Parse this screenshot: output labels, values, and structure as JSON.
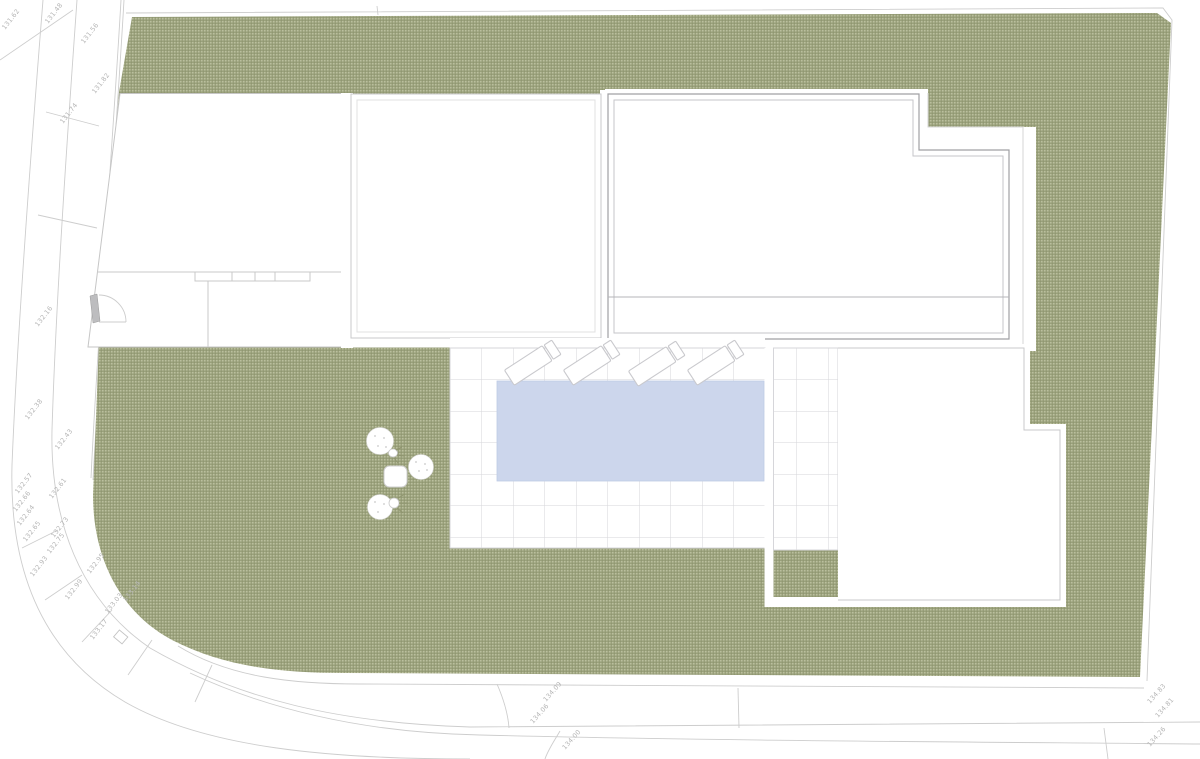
{
  "colors": {
    "vegetation_base": "#9aa17b",
    "vegetation_dot_light": "#c4c8a9",
    "vegetation_dot_dark": "#8a906c",
    "pool_water": "#ccd6ec",
    "building_outline": "#a0a0a4",
    "building_outline_light": "#c9c9cb",
    "tile_grid_line": "#d6d6da",
    "road_line": "#cdcdcd",
    "label_text": "#b5b5b5"
  },
  "elevation_labels": [
    "131.48",
    "131.62",
    "131.56",
    "131.82",
    "131.74",
    "132.16",
    "132.38",
    "132.43",
    "132.57",
    "132.61",
    "132.66",
    "132.64",
    "132.73",
    "132.65",
    "132.75",
    "132.93",
    "132.95",
    "132.99",
    "133.03",
    "133.14",
    "133.17",
    "134.09",
    "134.06",
    "134.00",
    "134.83",
    "134.81",
    "134.26"
  ]
}
